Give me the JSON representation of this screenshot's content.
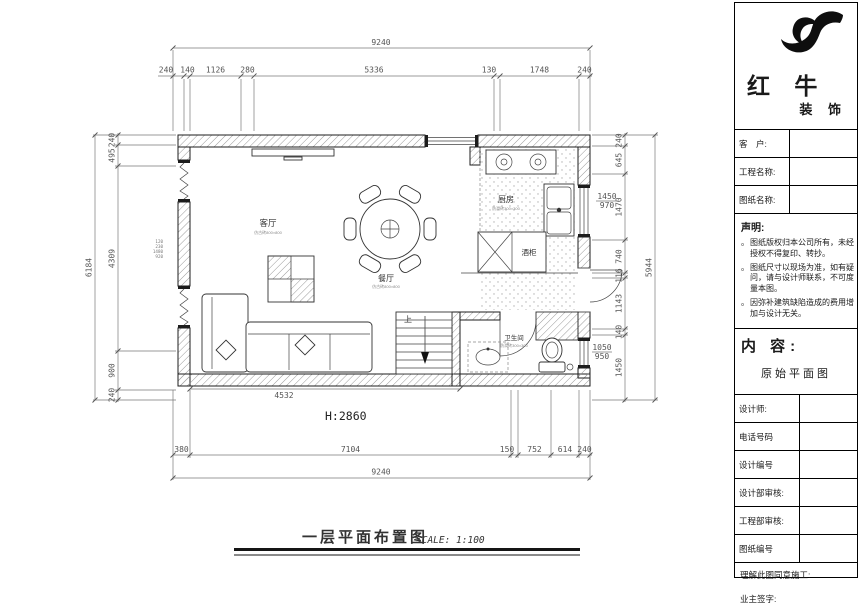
{
  "title_bar": {
    "title": "一层平面布置图",
    "scale": "SCALE: 1:100"
  },
  "panel": {
    "brand_main": "红 牛",
    "brand_sub": "装 饰",
    "fields": [
      {
        "label": "客　户:"
      },
      {
        "label": "工程名称:"
      },
      {
        "label": "图纸名称:"
      }
    ],
    "statement": {
      "heading": "声明:",
      "marker": "。",
      "items": [
        "图纸版权归本公司所有，未经授权不得复印、转抄。",
        "图纸尺寸以现场为准，如有疑问，请与设计师联系，不可度量本图。",
        "因弥补建筑缺陷造成的费用增加与设计无关。"
      ]
    },
    "content": {
      "heading": "内 容:",
      "value": "原始平面图"
    },
    "rows": [
      {
        "label": "设计师:"
      },
      {
        "label": "电话号码"
      },
      {
        "label": "设计编号"
      },
      {
        "label": "设计部审核:"
      },
      {
        "label": "工程部审核:"
      },
      {
        "label": "图纸编号"
      }
    ],
    "sig_line_1": "理解此图同意施工:",
    "sig_line_2": "业主签字:"
  },
  "plan": {
    "rooms": {
      "living": {
        "label": "客厅",
        "sub": "仿古砖800×800"
      },
      "dining": {
        "label": "餐厅",
        "sub": "仿古砖800×800"
      },
      "kitchen": {
        "label": "厨房",
        "sub": "防滑砖300×300"
      },
      "wine_cabinet": "酒柜",
      "bathroom": {
        "label": "卫生间",
        "sub": "防滑砖300×300"
      },
      "stairs": "上"
    },
    "height_note": "H:2860",
    "inner_dim": "4532",
    "kitchen_window": {
      "w": "1450",
      "h": "970"
    },
    "bath_window": {
      "w": "1050",
      "h": "950"
    },
    "left_wall_stack": [
      "120",
      "230",
      "1480",
      "920"
    ]
  },
  "dims": {
    "top_total": "9240",
    "top": [
      "240",
      "140",
      "1126",
      "280",
      "5336",
      "130",
      "1748",
      "240"
    ],
    "bottom": [
      "380",
      "7104",
      "150",
      "752",
      "614",
      "240"
    ],
    "bottom_total": "9240",
    "left_total": "6184",
    "left": [
      "240",
      "495",
      "4309",
      "900",
      "240"
    ],
    "right": [
      "240",
      "645",
      "1470",
      "740",
      "116",
      "1143",
      "140",
      "1450"
    ],
    "right_total": "5944"
  }
}
